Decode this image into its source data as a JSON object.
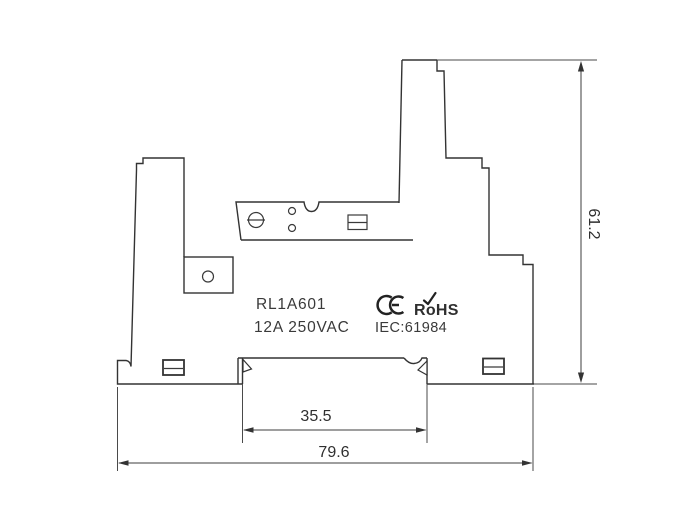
{
  "drawing": {
    "labels": {
      "part_number": "RL1A601",
      "rating": "12A 250VAC",
      "standard": "IEC:61984",
      "rohs": "RoHS",
      "ce_mark": "CE"
    },
    "dimensions": {
      "overall_height": "61.2",
      "din_rail_width": "35.5",
      "overall_width": "79.6"
    },
    "colors": {
      "line": "#333333",
      "text": "#3a3a3a",
      "background": "#ffffff"
    }
  }
}
